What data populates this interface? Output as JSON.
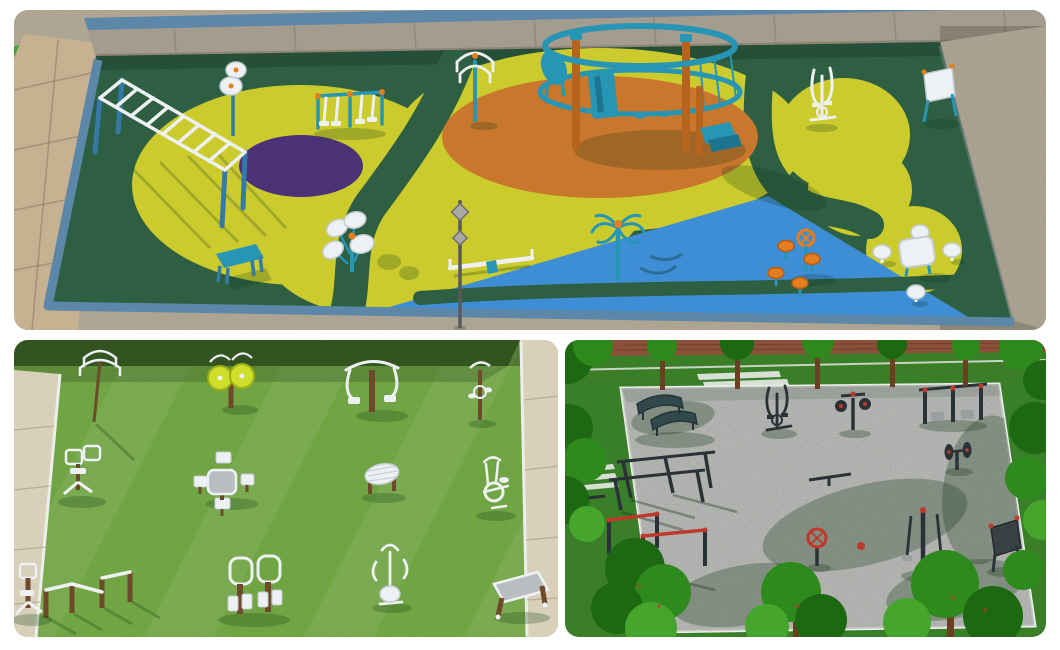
{
  "page": {
    "label": "Collage of three 3D renders of outdoor fitness equipment park layouts",
    "background": "#ffffff"
  },
  "panels": [
    {
      "label": "Colorful rubber-surface outdoor fitness park render with green, yellow, orange, purple and blue zones",
      "equipment": [
        "horizontal-ladder",
        "spinner-wheel-pole",
        "double-air-walker",
        "hanging-grip-station",
        "climbing-ring-tower",
        "elliptical-trainer",
        "sign-board",
        "plate-spinner-cluster",
        "bench",
        "balance-beam-seesaw",
        "street-lamp",
        "carousel-spinner",
        "mushroom-stools-with-wheel",
        "table-and-stools"
      ]
    },
    {
      "label": "Lawn outdoor gym render with white fitness machines and wooden posts",
      "equipment": [
        "arch-hanger-pole",
        "tai-chi-disc-station",
        "pull-down-station",
        "pedal-station",
        "rider-machine",
        "chess-table-set",
        "back-massage-roller",
        "exercise-bike",
        "push-up-bars",
        "double-leg-press",
        "stepper",
        "side-rider",
        "sit-up-board"
      ]
    },
    {
      "label": "Gravel calisthenics court render with dark steel equipment, red accents and trees",
      "equipment": [
        "curved-benches",
        "slanted-parallel-bars",
        "red-pull-up-bars",
        "elliptical-machine",
        "spin-disc-station",
        "dip-station",
        "weight-disc-post",
        "tai-chi-wheel",
        "dual-pendulum-walker",
        "notice-board"
      ]
    }
  ],
  "colors": {
    "page_bg": "#ffffff",
    "sand": "#cec4ae",
    "paver": "#c6b291",
    "wall": "#a49c8e",
    "wall_dark": "#8d8476",
    "rail_blue": "#5d87a9",
    "park_green": "#2e5f43",
    "blob_yellow": "#cbcb2d",
    "circle_purple": "#4b3277",
    "ellipse_orange": "#c8772c",
    "tri_blue": "#3e8ed5",
    "equip_teal": "#2795b4",
    "teal_dark": "#1d7490",
    "post_blue": "#3579a8",
    "equip_orange": "#e47d1e",
    "white_metal": "#eef1f3",
    "metal_edge": "#c2ccd2",
    "wood_warm": "#b5651d",
    "lawn_green": "#7eb84c",
    "lawn_dark": "#6da53f",
    "hedge_green": "#46742c",
    "path_beige": "#d9d0ba",
    "wood_brown": "#6e492a",
    "grass_dark": "#42902e",
    "brick_red": "#8a5038",
    "gravel_gray": "#c7cac5",
    "curb_white": "#eceeea",
    "tree_dark": "#1d6912",
    "tree_mid": "#2e8a1c",
    "tree_light": "#45a52c",
    "trunk_brown": "#6b3f22",
    "metal_dark": "#2b3237",
    "accent_red": "#bf392b",
    "table_gray": "#b9bdbf"
  }
}
